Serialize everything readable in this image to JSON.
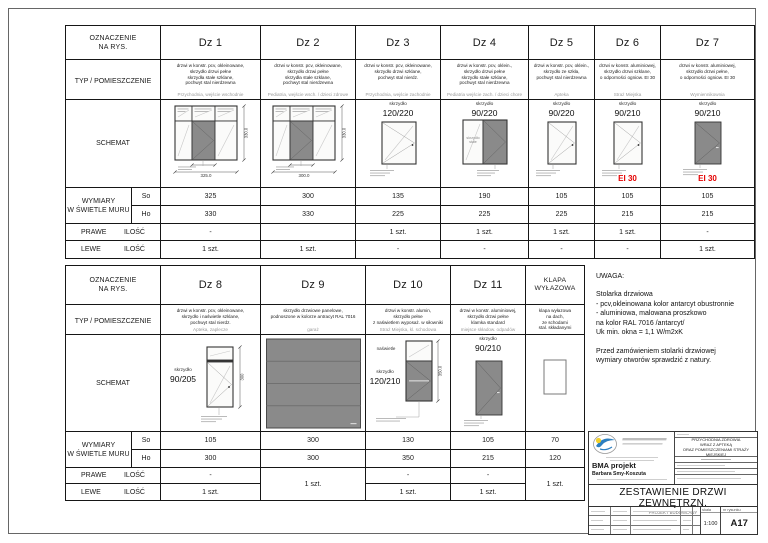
{
  "top_table": {
    "labels": {
      "designation": "OZNACZENIE\nNA RYS.",
      "type_room": "TYP / POMIESZCZENIE",
      "schematic": "SCHEMAT",
      "dimensions": "WYMIARY\nW ŚWIETLE MURU",
      "so": "So",
      "ho": "Ho",
      "right": "PRAWE",
      "left": "LEWE",
      "qty": "ILOŚĆ"
    },
    "doors": [
      {
        "id": "Dz 1",
        "schematic": "triple",
        "desc": "drzwi w konstr. pcv, okleinowane,\nskrzydło drzwi pełne\nskrzydła stałe szklane,\npochwyt stal nierdzewna",
        "location": "Przychodnia, wejście wschodnie",
        "dim_w": "325.0",
        "dim_h": "330.0",
        "so": "325",
        "ho": "330",
        "right_qty": "-",
        "left_qty": "1 szt."
      },
      {
        "id": "Dz 2",
        "schematic": "triple",
        "desc": "drzwi w konstr. pcv, okleinowane,\nskrzydło drzwi pełne\nskrzydła stałe szklane,\npochwyt stal nierdzewna",
        "location": "Pediatria, wejście wsch. / dzieci zdrowe",
        "dim_w": "300.0",
        "dim_h": "330.0",
        "so": "300",
        "ho": "330",
        "right_qty": "",
        "left_qty": "1 szt."
      },
      {
        "id": "Dz 3",
        "schematic": "glazed",
        "leaf": "skrzydło",
        "leaf_size": "120/220",
        "desc": "drzwi w konstr. pcv, okleinowane,\nskrzydło drzwi szklane,\npochwyt stal nierdz.",
        "location": "Przychodnia, wejście zachodnie",
        "so": "135",
        "ho": "225",
        "right_qty": "1 szt.",
        "left_qty": "-"
      },
      {
        "id": "Dz 4",
        "schematic": "fixed_dark",
        "leaf": "skrzydło",
        "leaf_size": "90/220",
        "fixed_label": "skrzydło\nstałe",
        "desc": "drzwi w konstr. pcv, oklein.,\nskrzydło drzwi pełne\nskrzydło stałe szklane,\npochwyt stal nierdzewna",
        "location": "Pediatria wejście zach. / dzieci chore",
        "so": "190",
        "ho": "225",
        "right_qty": "1 szt.",
        "left_qty": "-"
      },
      {
        "id": "Dz 5",
        "schematic": "glazed",
        "leaf": "skrzydło",
        "leaf_size": "90/220",
        "desc": "drzwi w konstr. pcv, oklein.,\nskrzydło ze szkła,\npochwyt stal nierdzewna",
        "location": "Apteka",
        "so": "105",
        "ho": "225",
        "right_qty": "1 szt.",
        "left_qty": "-"
      },
      {
        "id": "Dz 6",
        "schematic": "glazed",
        "leaf": "skrzydło",
        "leaf_size": "90/210",
        "fire": "EI 30",
        "desc": "drzwi w konstr. aluminiowej,\nskrzydło drzwi szklane,\no odporności ogniow. EI 30",
        "location": "Straż Miejska",
        "so": "105",
        "ho": "215",
        "right_qty": "1 szt.",
        "left_qty": "-"
      },
      {
        "id": "Dz 7",
        "schematic": "dark_labeled",
        "leaf": "skrzydło",
        "leaf_size": "90/210",
        "fire": "EI 30",
        "desc": "drzwi w konstr. aluminiowej,\nskrzydło drzwi pełne,\no odporności ogniow. EI 30",
        "location": "Wymiennikownia",
        "so": "105",
        "ho": "215",
        "right_qty": "-",
        "left_qty": "1 szt."
      }
    ]
  },
  "bottom_table": {
    "doors": [
      {
        "id": "Dz 8",
        "schematic": "transom_glass",
        "leaf": "skrzydło",
        "leaf_size": "90/205",
        "dim_h": "300",
        "desc": "drzwi w konstr. pcv, okleinowane,\nskrzydło i naświetle szklane,\npochwyt stal nierdz.",
        "location": "Apteka, zaplecze",
        "so": "105",
        "ho": "300",
        "right_qty": "-",
        "left_qty": "1 szt."
      },
      {
        "id": "Dz 9",
        "schematic": "garage",
        "desc": "skrzydło drzwiowe panelowe,\npodnoszone w kolorze antracyt RAL 7016",
        "location": "garaż",
        "so": "300",
        "ho": "300",
        "merged_qty": "1 szt."
      },
      {
        "id": "Dz 10",
        "schematic": "transom_dark",
        "leaf": "skrzydło",
        "leaf_size": "120/210",
        "transom_label": "naświetle",
        "dim_h": "350.0",
        "desc": "drzwi w konstr. alumin,\nskrzydło pełne\nz naświetlem wyposaż. w siłowniki",
        "location": "Straż Miejska, kl. schodowa",
        "so": "130",
        "ho": "350",
        "right_qty": "-",
        "left_qty": "1 szt."
      },
      {
        "id": "Dz 11",
        "schematic": "dark_labeled",
        "leaf": "skrzydło",
        "leaf_size": "90/210",
        "desc": "drzwi w konstr. aluminiowej,\nskrzydło drzwi pełne\nklamka standard",
        "location": "miejsce składow. odpadów",
        "so": "105",
        "ho": "215",
        "right_qty": "-",
        "left_qty": "1 szt."
      },
      {
        "id": "KLAPA\nWYŁAZOWA",
        "schematic": "hatch",
        "desc": "klapa wyłazowa\nna dach,\nze schodami\nstal. składanymi",
        "location": "",
        "so": "70",
        "ho": "120",
        "merged_qty": "1 szt."
      }
    ]
  },
  "uwaga": {
    "title": "UWAGA:",
    "body": "Stolarka drzwiowa\n- pcv,okleinowana kolor antarcyt obustronnie\n- aluminiowa, malowana proszkowo\n   na kolor RAL 7016 /antarcyt/\nUk min. okna = 1,1 W/m2xK\n\nPrzed zamówieniem stolarki drzwiowej\nwymiary otworów sprawdzić z natury."
  },
  "title_block": {
    "company": "BMA projekt",
    "person": "Barbara Smy-Koszuta",
    "project_lines": "PRZYCHODNIA ZDROWIA\nWRAZ Z APTEKĄ\nORAZ POMIESZCZENIAMI STRAŻY MIEJSKIEJ",
    "drawing_title": "ZESTAWIENIE DRZWI ZEWNĘTRZN.",
    "stage": "PROJEKT BUDOWLANY",
    "scale_label": "skala",
    "scale": "1:100",
    "number_label": "nr rysunku",
    "number": "A17"
  },
  "colors": {
    "fire_red": "#e40000",
    "leaf_gray": "#8a8a8a",
    "accent_blue": "#2d7fc0",
    "accent_yellow": "#f2d02a"
  }
}
